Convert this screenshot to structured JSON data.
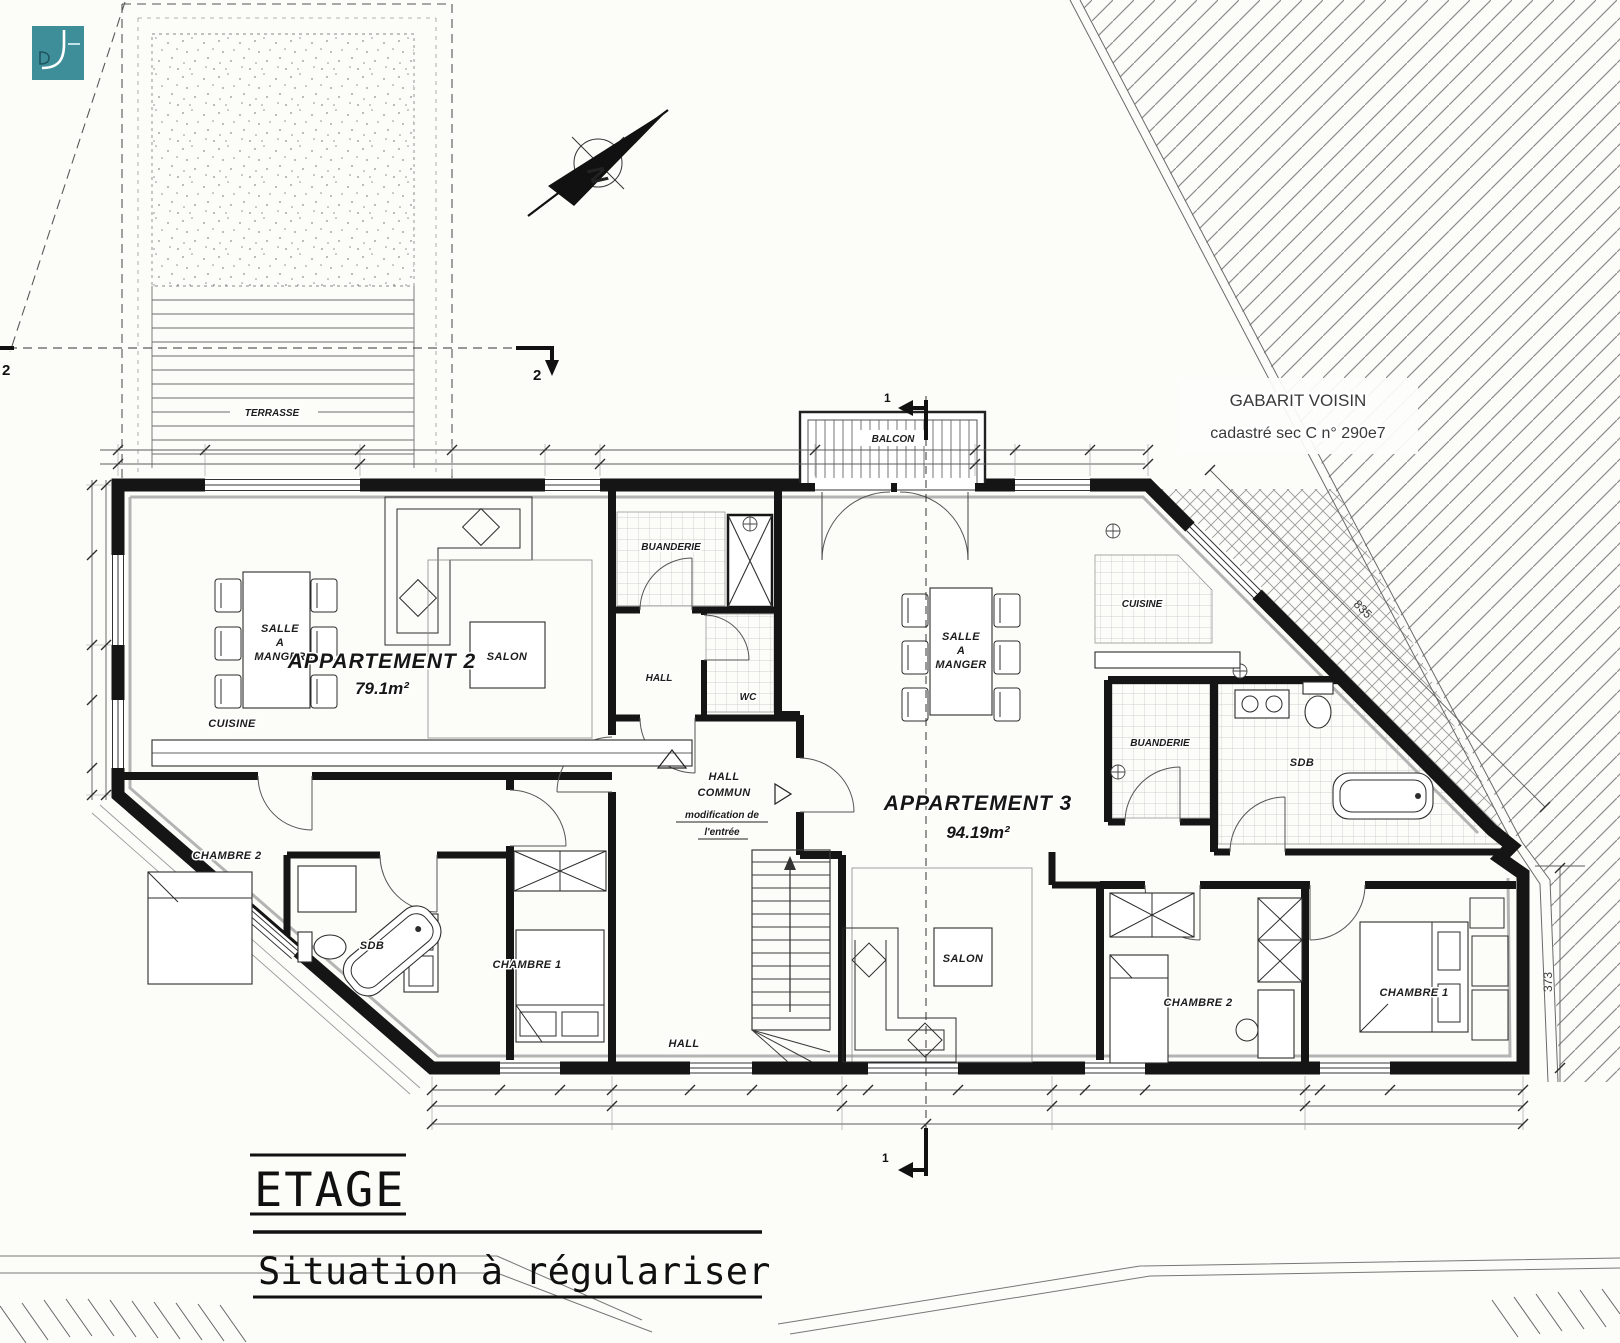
{
  "canvas": {
    "background": "#fcfcf8",
    "ink": "#1a1a1a",
    "logo_color": "#3e8e9a",
    "logo_icon": "df-monogram-icon"
  },
  "titles": {
    "floor": "ETAGE",
    "status": "Situation à régulariser"
  },
  "site": {
    "neighbor_line1": "GABARIT VOISIN",
    "neighbor_line2": "cadastré sec C n° 290e7",
    "terrace": "TERRASSE",
    "balcony": "BALCON",
    "north": "N"
  },
  "sections": {
    "cut1": "1",
    "cut2": "2"
  },
  "dims": {
    "diagonal": "835",
    "right_side": "373"
  },
  "common": {
    "laundry": "BUANDERIE",
    "hall_top": "HALL",
    "wc": "WC",
    "hall_main1": "HALL",
    "hall_main2": "COMMUN",
    "note1": "modification de",
    "note2": "l'entrée",
    "hall_bottom": "HALL"
  },
  "apt2": {
    "title": "APPARTEMENT 2",
    "area": "79.1m²",
    "dining1": "SALLE",
    "dining2": "A",
    "dining3": "MANGER",
    "living": "SALON",
    "kitchen": "CUISINE",
    "bedroom2": "CHAMBRE 2",
    "bath": "SDB",
    "bedroom1": "CHAMBRE 1"
  },
  "apt3": {
    "title": "APPARTEMENT 3",
    "area": "94.19m²",
    "dining1": "SALLE",
    "dining2": "A",
    "dining3": "MANGER",
    "living": "SALON",
    "kitchen": "CUISINE",
    "laundry": "BUANDERIE",
    "bath": "SDB",
    "bedroom2": "CHAMBRE 2",
    "bedroom1": "CHAMBRE 1"
  }
}
